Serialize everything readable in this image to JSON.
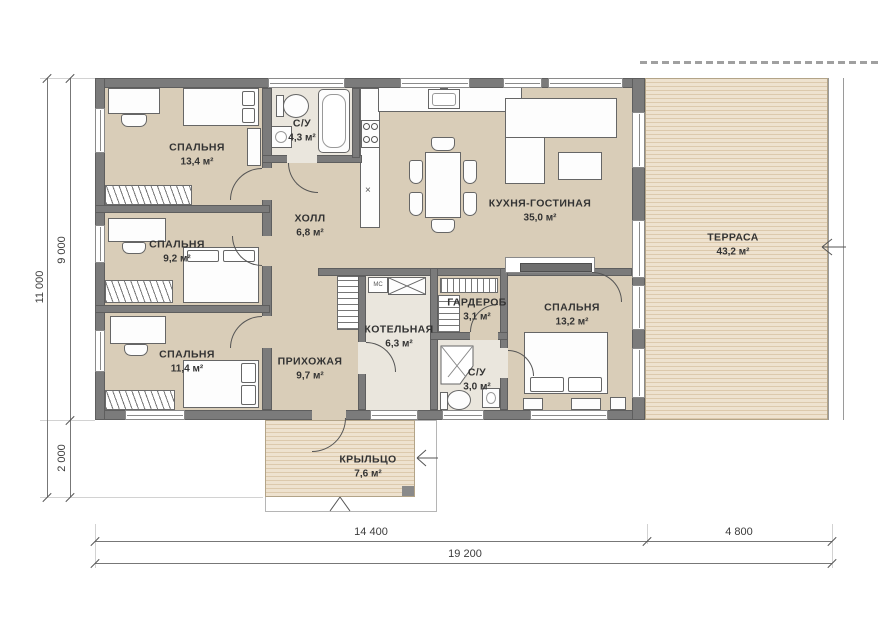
{
  "plan": {
    "rooms": [
      {
        "id": "bedroom-1",
        "name": "СПАЛЬНЯ",
        "area": "13,4 м²"
      },
      {
        "id": "bathroom-1",
        "name": "С/У",
        "area": "4,3 м²"
      },
      {
        "id": "hall",
        "name": "ХОЛЛ",
        "area": "6,8 м²"
      },
      {
        "id": "kitchen-living",
        "name": "КУХНЯ-ГОСТИНАЯ",
        "area": "35,0 м²"
      },
      {
        "id": "terrace",
        "name": "ТЕРРАСА",
        "area": "43,2 м²"
      },
      {
        "id": "bedroom-2",
        "name": "СПАЛЬНЯ",
        "area": "9,2 м²"
      },
      {
        "id": "boiler-room",
        "name": "КОТЕЛЬНАЯ",
        "area": "6,3 м²"
      },
      {
        "id": "wardrobe-room",
        "name": "ГАРДЕРОБ",
        "area": "3,1 м²"
      },
      {
        "id": "bedroom-3",
        "name": "СПАЛЬНЯ",
        "area": "13,2 м²"
      },
      {
        "id": "bedroom-4",
        "name": "СПАЛЬНЯ",
        "area": "11,4 м²"
      },
      {
        "id": "entry-hall",
        "name": "ПРИХОЖАЯ",
        "area": "9,7 м²"
      },
      {
        "id": "bathroom-2",
        "name": "С/У",
        "area": "3,0 м²"
      },
      {
        "id": "porch",
        "name": "КРЫЛЬЦО",
        "area": "7,6 м²"
      }
    ],
    "annotations": {
      "mc": "МС",
      "x_mark": "×"
    },
    "dimensions": {
      "left_total": "11 000",
      "left_house": "9 000",
      "left_porch": "2 000",
      "bottom_house": "14 400",
      "bottom_terrace": "4 800",
      "bottom_total": "19 200"
    },
    "colors": {
      "wall": "#7b7b7b",
      "floor": "#d9cdb8",
      "tile": "#eae6dd",
      "deck": "#ecdfc9"
    }
  }
}
